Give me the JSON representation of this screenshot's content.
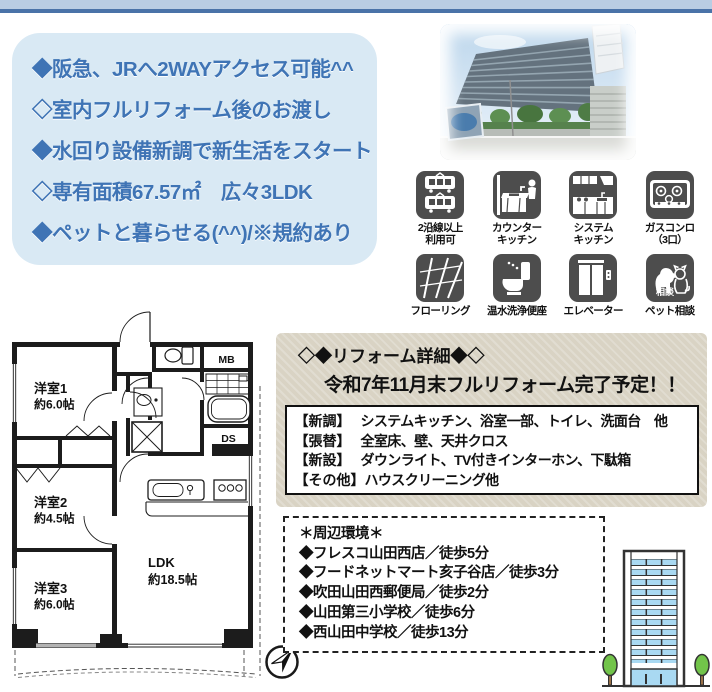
{
  "header": {
    "bar_color_light": "#b9cde3",
    "bar_color_dark": "#4a73a8"
  },
  "features": {
    "bg": "#d9e9f4",
    "text_color": "#3f74b5",
    "items": [
      "◆阪急、JRへ2WAYアクセス可能^^",
      "◇室内フルリフォーム後のお渡し",
      "◆水回り設備新調で新生活をスタート",
      "◇専有面積67.57㎡　広々3LDK",
      "◆ペットと暮らせる(^^)/※規約あり"
    ]
  },
  "photo": {
    "description": "マンション外観写真"
  },
  "amenities": {
    "tile_color": "#4d4d4d",
    "items": [
      {
        "icon": "train-icon",
        "label": "2沿線以上\n利用可"
      },
      {
        "icon": "counter-kitchen-icon",
        "label": "カウンター\nキッチン"
      },
      {
        "icon": "system-kitchen-icon",
        "label": "システム\nキッチン"
      },
      {
        "icon": "gas-stove-icon",
        "label": "ガスコンロ\n（3口）"
      },
      {
        "icon": "flooring-icon",
        "label": "フローリング"
      },
      {
        "icon": "washlet-icon",
        "label": "温水洗浄便座"
      },
      {
        "icon": "elevator-icon",
        "label": "エレベーター"
      },
      {
        "icon": "pet-icon",
        "label": "ペット相談",
        "badge": "相談"
      }
    ]
  },
  "floorplan": {
    "rooms": [
      {
        "name": "洋室1",
        "size": "約6.0帖"
      },
      {
        "name": "洋室2",
        "size": "約4.5帖"
      },
      {
        "name": "洋室3",
        "size": "約6.0帖"
      },
      {
        "name": "LDK",
        "size": "約18.5帖"
      }
    ],
    "labels": {
      "meter_box": "MB",
      "duct_space": "DS"
    },
    "compass": "N"
  },
  "reform": {
    "bg": "#d9d3c4",
    "title": "◇◆リフォーム詳細◆◇",
    "subtitle": "令和7年11月末フルリフォーム完了予定！！",
    "rows": [
      {
        "label": "【新調】",
        "text": "システムキッチン、浴室一部、トイレ、洗面台　他"
      },
      {
        "label": "【張替】",
        "text": "全室床、壁、天井クロス"
      },
      {
        "label": "【新設】",
        "text": "ダウンライト、TV付きインターホン、下駄箱"
      },
      {
        "label": "【その他】",
        "text": "ハウスクリーニング他"
      }
    ]
  },
  "environment": {
    "title": "＊周辺環境＊",
    "items": [
      "◆フレスコ山田西店／徒歩5分",
      "◆フードネットマート亥子谷店／徒歩3分",
      "◆吹田山田西郵便局／徒歩2分",
      "◆山田第三小学校／徒歩6分",
      "◆西山田中学校／徒歩13分"
    ]
  }
}
